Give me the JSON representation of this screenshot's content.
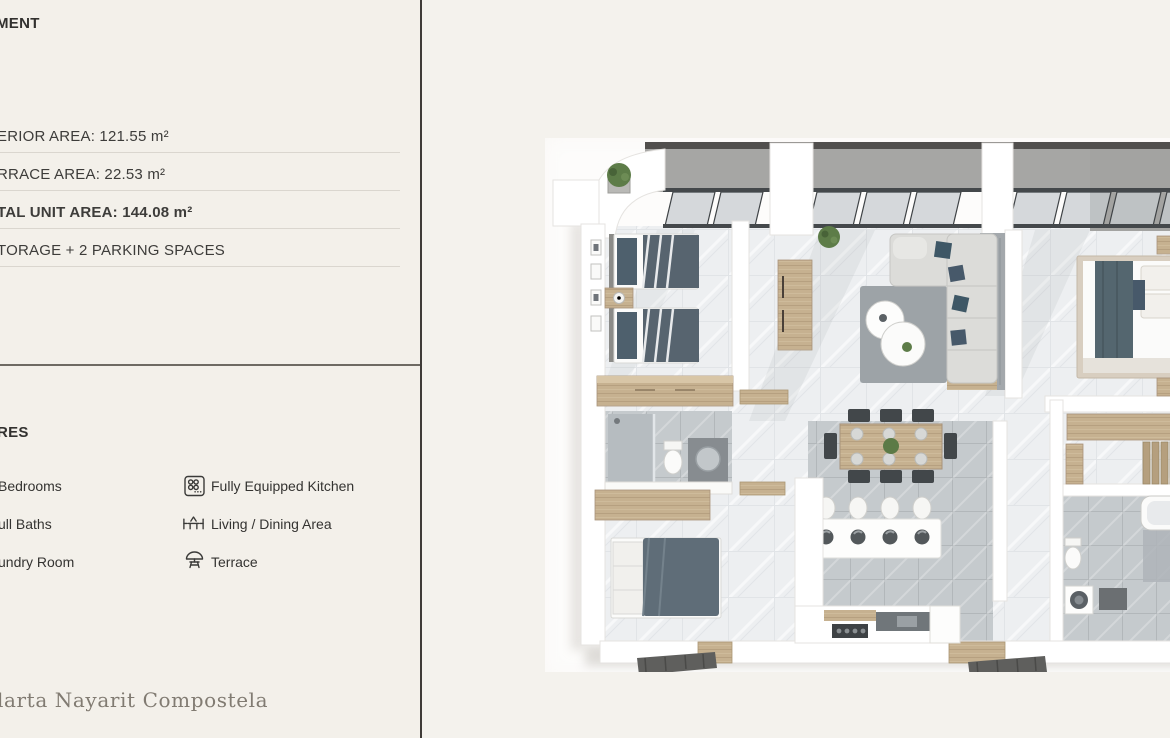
{
  "page": {
    "background_left": "#f3f0ea",
    "background_right": "#f4f2ed",
    "divider_color": "#3f3c38",
    "text_color": "#3d3c3a"
  },
  "header": {
    "title": "MENT"
  },
  "specs": {
    "rows": [
      {
        "text": "ERIOR AREA: 121.55 m²",
        "bold": false
      },
      {
        "text": "RRACE AREA: 22.53 m²",
        "bold": false
      },
      {
        "text": "TAL UNIT AREA: 144.08 m²",
        "bold": true
      },
      {
        "text": "TORAGE + 2 PARKING SPACES",
        "bold": false
      }
    ]
  },
  "features": {
    "heading": "RES",
    "left_items": [
      {
        "label": "Bedrooms"
      },
      {
        "label": "ull Baths"
      },
      {
        "label": "undry Room"
      }
    ],
    "right_items": [
      {
        "icon": "stove-icon",
        "label": "Fully Equipped Kitchen"
      },
      {
        "icon": "dining-table-icon",
        "label": "Living / Dining Area"
      },
      {
        "icon": "umbrella-table-icon",
        "label": "Terrace"
      }
    ]
  },
  "footer": {
    "brand": "larta Nayarit Compostela"
  },
  "floor_plan_colors": {
    "concrete": "#a6a6a4",
    "marble_floor": "#edeff1",
    "gray_tile": "#c5cacd",
    "wood": "#c6b190",
    "slate_bedding": "#57646f",
    "teal_accent": "#47596a",
    "sofa": "#dcdcd9",
    "wall": "#ffffff"
  }
}
